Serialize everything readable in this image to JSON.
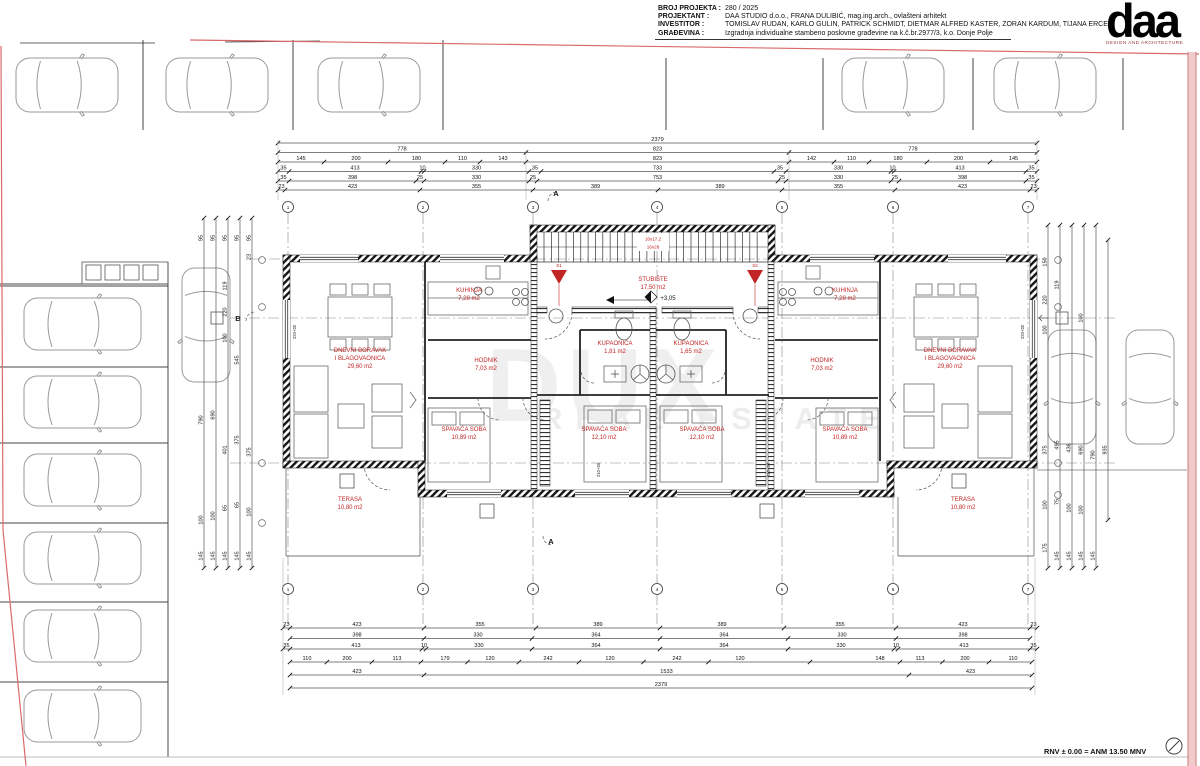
{
  "title_block": {
    "rows": [
      {
        "label": "BROJ PROJEKTA :",
        "value": "280 / 2025"
      },
      {
        "label": "PROJEKTANT :",
        "value": "DAA STUDIO d.o.o., FRANA DULIBIĆ, mag.ing.arch., ovlašteni arhitekt"
      },
      {
        "label": "INVESTITOR :",
        "value": "TOMISLAV RUDAN, KARLO GULIN, PATRICK SCHMIDT,  DIETMAR ALFRED KASTER, ZORAN KARDUM, TIJANA ERCEG"
      },
      {
        "label": "GRAĐEVINA :",
        "value": "Izgradnja individualne stambeno poslovne građevine na k.č.br.2977/3, k.o. Donje Polje"
      }
    ]
  },
  "logo": {
    "text": "daa",
    "subtitle": "DESIGN AND ARCHITECTURE"
  },
  "watermark": {
    "line1": "DUX",
    "line2": "REAL ESTATE"
  },
  "notes": {
    "rnv": "RNV ± 0.00 = ANM 13.50 MNV"
  },
  "plan": {
    "rooms": [
      {
        "name": "DNEVNI BORAVAK",
        "name2": "I BLAGOVAONICA",
        "area": "29,60 m2"
      },
      {
        "name": "KUHINJA",
        "area": "7,28 m2"
      },
      {
        "name": "HODNIK",
        "area": "7,03 m2"
      },
      {
        "name": "KUPAONICA",
        "area": "1,81 m2"
      },
      {
        "name": "SPAVAĆA SOBA",
        "area": "10,89 m2"
      },
      {
        "name": "SPAVAĆA SOBA",
        "area": "12,10 m2"
      },
      {
        "name": "TERASA",
        "area": "10,80 m2"
      },
      {
        "name": "STUBIŠTE",
        "area": "17,50 m2"
      },
      {
        "name": "KUPAONICA",
        "area": "1,65 m2"
      },
      {
        "name": "SPAVAĆA SOBA",
        "area": "12,10 m2"
      },
      {
        "name": "SPAVAĆA SOBA",
        "area": "10,89 m2"
      },
      {
        "name": "HODNIK",
        "area": "7,03 m2"
      },
      {
        "name": "KUHINJA",
        "area": "7,28 m2"
      },
      {
        "name": "DNEVNI BORAVAK",
        "name2": "I BLAGOVAONICA",
        "area": "29,60 m2"
      },
      {
        "name": "TERASA",
        "area": "10,80 m2"
      }
    ],
    "stair_notes": [
      "16x17,2",
      "16x28"
    ],
    "level": "+3,05",
    "drains": [
      "S1",
      "S2"
    ],
    "sections": {
      "a": "A",
      "b": "B"
    },
    "grid_numbers": [
      "1",
      "2",
      "3",
      "4",
      "5",
      "6",
      "7"
    ],
    "bed_notes": [
      "210+30",
      "210+30"
    ],
    "parapet_notes": [
      "220+30",
      "220+30"
    ]
  },
  "dimensions": {
    "top": [
      [
        "2379"
      ],
      [
        "778",
        "823",
        "778"
      ],
      [
        "145",
        "200",
        "180",
        "110",
        "143",
        "823",
        "142",
        "110",
        "180",
        "200",
        "145"
      ],
      [
        "35",
        "413",
        "10",
        "330",
        "35",
        "733",
        "35",
        "330",
        "10",
        "413",
        "35"
      ],
      [
        "35",
        "398",
        "25",
        "330",
        "25",
        "753",
        "25",
        "330",
        "25",
        "398",
        "35"
      ],
      [
        "23",
        "423",
        "355",
        "389",
        "389",
        "355",
        "423",
        "23"
      ]
    ],
    "bottom": [
      [
        "23",
        "423",
        "355",
        "389",
        "389",
        "355",
        "423",
        "23"
      ],
      [
        "398",
        "330",
        "364",
        "364",
        "330",
        "398"
      ],
      [
        "35",
        "413",
        "10",
        "330",
        "364",
        "364",
        "330",
        "10",
        "413",
        "35"
      ],
      [
        "110",
        "200",
        "113",
        "179",
        "120",
        "242",
        "120",
        "242",
        "120",
        "148",
        "113",
        "200",
        "110"
      ],
      [
        "423",
        "1533",
        "423"
      ],
      [
        "2379"
      ]
    ],
    "left": [
      [
        "95",
        "790",
        "100",
        "145"
      ],
      [
        "95",
        "690",
        "100",
        "145"
      ],
      [
        "95",
        "119",
        "220",
        "100",
        "401",
        "65",
        "145"
      ],
      [
        "95",
        "545",
        "375",
        "65",
        "145"
      ],
      [
        "95",
        "23",
        "375",
        "100",
        "145"
      ]
    ],
    "right": [
      [
        "150",
        "220",
        "100",
        "375",
        "100",
        "175"
      ],
      [
        "119",
        "495",
        "75",
        "145"
      ],
      [
        "436",
        "100",
        "145"
      ],
      [
        "100",
        "690",
        "100",
        "145"
      ],
      [
        "790",
        "145"
      ],
      [
        "935"
      ]
    ]
  }
}
